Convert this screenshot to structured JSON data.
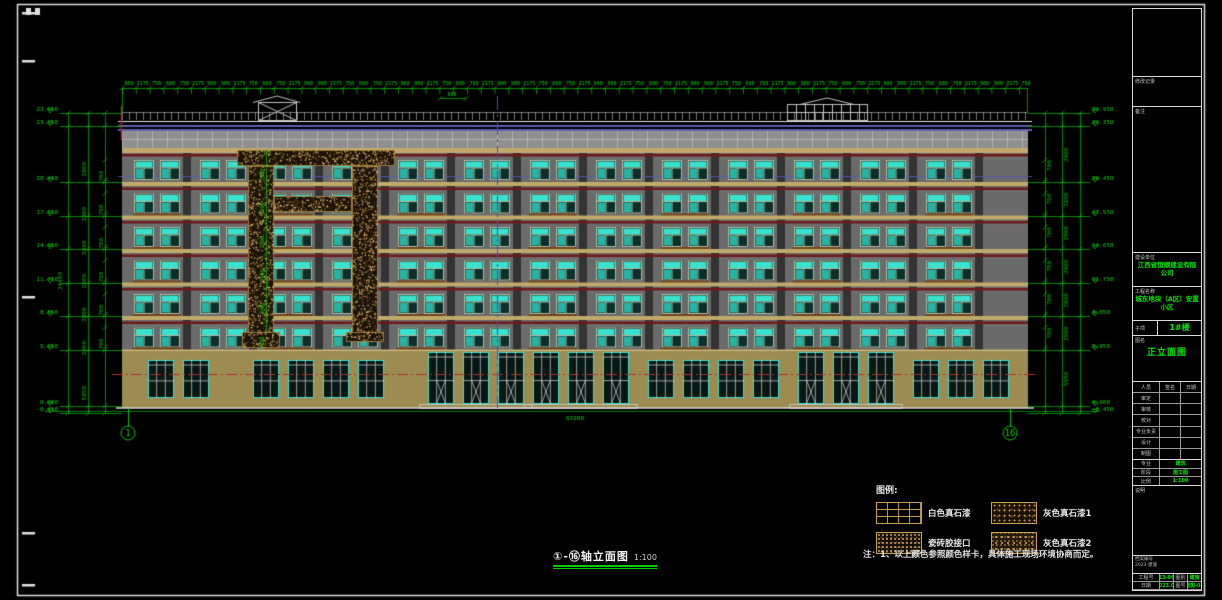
{
  "colors": {
    "bg": "#000000",
    "frame_white": "#e0e0e0",
    "dim_green": "#00c400",
    "label_green": "#00d800",
    "window_cyan": "#38e2ce",
    "glass_dark": "#0d2f2b",
    "frame_pale": "#d9d9b5",
    "band_tan": "#c0aa6a",
    "stripe_red": "#6e1a1a",
    "wall_gray": "#6a6a6a",
    "pier_dark": "#333333",
    "ground_tan": "#9c8c52",
    "parapet_blue": "#8080e8",
    "centerline_red": "#b03030",
    "axis_blue": "#4848d8",
    "speckle_bg": "#1c1208",
    "speckle_dot": "#c29a50"
  },
  "elevation": {
    "axis_left": "1",
    "axis_right": "16",
    "levels": [
      {
        "label": "23.950",
        "y": 113
      },
      {
        "label": "23.350",
        "y": 126
      },
      {
        "label": "20.450",
        "y": 182
      },
      {
        "label": "17.550",
        "y": 216
      },
      {
        "label": "14.650",
        "y": 249
      },
      {
        "label": "11.750",
        "y": 283
      },
      {
        "label": "8.850",
        "y": 316
      },
      {
        "label": "5.950",
        "y": 350
      },
      {
        "label": "0.000",
        "y": 406
      },
      {
        "label": "-0.450",
        "y": 413
      }
    ],
    "floor_dim": "2900",
    "ground_dim": "5950",
    "sub_dims": [
      "700",
      "2200"
    ],
    "top_dims": [
      "900",
      "2175",
      "750",
      "600",
      "750",
      "2175",
      "900"
    ],
    "roof_dim": "600",
    "total_width_dim": "63200"
  },
  "legend": {
    "title": "图例:",
    "items": [
      {
        "name": "白色真石漆",
        "pattern": "grid"
      },
      {
        "name": "瓷砖胶接口",
        "pattern": "hatch"
      },
      {
        "name": "灰色真石漆1",
        "pattern": "speckle"
      },
      {
        "name": "灰色真石漆2",
        "pattern": "speckle2"
      }
    ],
    "note": "注：1、以上颜色参照颜色样卡，具体施工现场环境协商而定。"
  },
  "drawing_title": {
    "text": "①-⑯轴立面图",
    "scale": "1:100"
  },
  "title_block": {
    "revision_label": "修改记录",
    "note_label": "备注",
    "company_label": "建设单位",
    "company": "江西省恒顺建设有限公司",
    "project_label": "工程名称",
    "project": "城东地块（A区）安置小区",
    "subitem_label": "子项",
    "subitem": "1#楼",
    "sheet_label": "图名",
    "sheet_name": "正立面图",
    "personnel_header": [
      "人员",
      "签名",
      "日期"
    ],
    "personnel_rows": [
      "审定",
      "审核",
      "校对",
      "专业负责",
      "设计",
      "制图"
    ],
    "stage_rows": [
      [
        "专业",
        "建筑"
      ],
      [
        "阶段",
        "施工图"
      ],
      [
        "比例",
        "1:100"
      ]
    ],
    "remark_label": "说明",
    "file_line1": "档案编号",
    "file_line2": "2023-建施",
    "bottom_rows": [
      [
        "工程号",
        "23-06"
      ],
      [
        "图别",
        "建施"
      ],
      [
        "日期",
        "2023.06"
      ],
      [
        "图号",
        "建施-08"
      ],
      [
        "比例",
        "1:100"
      ],
      [
        "页次",
        "08"
      ]
    ]
  }
}
